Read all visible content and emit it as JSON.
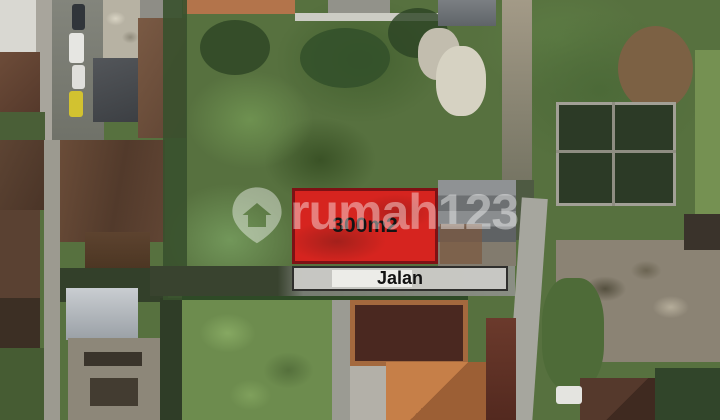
{
  "overlay": {
    "plot": {
      "area_label": "300m2",
      "fill_color": "#e01e1d",
      "border_color": "#7e1114",
      "label_color": "#141414"
    },
    "road_band": {
      "label": "Jalan",
      "fill_color": "#cbcbc7",
      "border_color": "#2f2f2d",
      "label_color": "#131313"
    },
    "watermark": {
      "brand_text": "rumah123",
      "icon": "pin-house-icon",
      "color": "#ffffff",
      "opacity": "0.42"
    }
  },
  "scene": {
    "description": "aerial drone photo of a vacant 300m2 land plot beside a road, surrounded by houses, rooftops and vegetation"
  }
}
